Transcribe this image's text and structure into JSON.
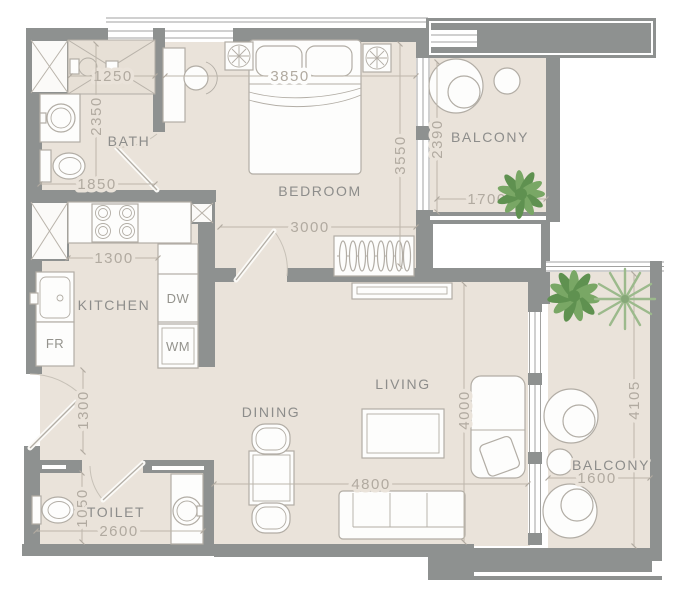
{
  "floor_plan": {
    "room_labels": {
      "bath": "BATH",
      "bedroom": "BEDROOM",
      "balcony_top": "BALCONY",
      "kitchen": "KITCHEN",
      "dining": "DINING",
      "living": "LIVING",
      "toilet": "TOILET",
      "balcony_right": "BALCONY"
    },
    "appliance_labels": {
      "dishwasher": "DW",
      "washing_machine": "WM",
      "fridge": "FR"
    },
    "dimensions_mm": {
      "shower_width": "1250",
      "bath_length": "2350",
      "bath_width": "1850",
      "bedroom_width": "3850",
      "bedroom_length": "3550",
      "bedroom_wall": "3000",
      "balcony_top_length": "2390",
      "balcony_top_width": "1700",
      "kitchen_width": "1300",
      "entry_length": "1300",
      "toilet_length": "1050",
      "toilet_width": "2600",
      "living_width": "4800",
      "living_length": "4000",
      "balcony_right_length": "4105",
      "balcony_right_width": "1600"
    },
    "colors": {
      "wall": "#8e9190",
      "floor": "#eae3da",
      "dimension_text": "#b1aaa0",
      "room_text": "#8d8d8b",
      "plant_green": "#79a765",
      "palm_green": "#9cba8c",
      "furniture_stroke": "#b2ada5"
    }
  }
}
